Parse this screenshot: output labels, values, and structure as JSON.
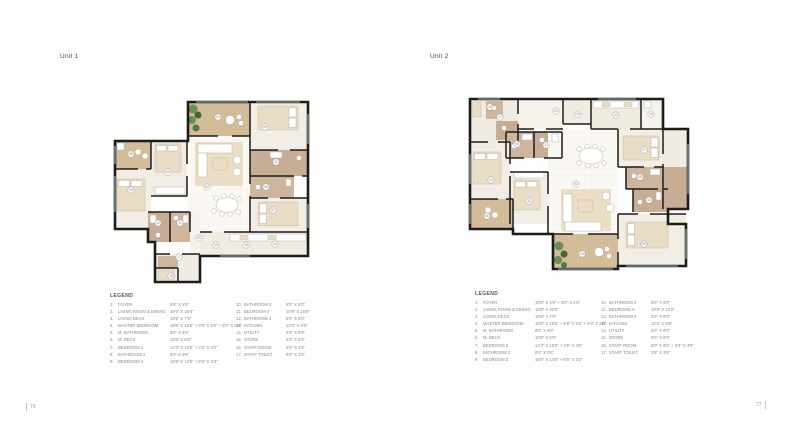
{
  "page": {
    "left_page_number": "76",
    "right_page_number": "77"
  },
  "palette": {
    "wall": "#1c1c1c",
    "deck_wood": "#d6bf9c",
    "room_floor": "#f3eee5",
    "bathroom": "#c7ad94",
    "bathroom_light": "#cdb59e",
    "plant_green": "#6a8e55",
    "rug": "#e7d9bc",
    "window": "#9fb9b5"
  },
  "units": [
    {
      "title": "Unit 1",
      "legend_title": "LEGEND",
      "legend": [
        {
          "num": "1.",
          "label": "FOYER",
          "dim": "5'6\" X 8'9\""
        },
        {
          "num": "2.",
          "label": "LIVING ROOM & DINING",
          "dim": "18'6\" X 28'6\""
        },
        {
          "num": "3.",
          "label": "LIVING DECK",
          "dim": "18'6\" X 7'9\""
        },
        {
          "num": "4.",
          "label": "MASTER BEDROOM",
          "dim": "18'6\" X 16'6\" + 8'9\" X 5'6\" + 6'0\" X 2'0\""
        },
        {
          "num": "5.",
          "label": "M. BATHROOM",
          "dim": "8'0\" X 8'6\""
        },
        {
          "num": "6.",
          "label": "M. DECK",
          "dim": "18'6\" X 5'9\""
        },
        {
          "num": "7.",
          "label": "BEDROOM 2",
          "dim": "12'3\" X 10'9\" + 3'6\" X 4'0\""
        },
        {
          "num": "8.",
          "label": "BATHROOM 2",
          "dim": "8'0\" X 5'6\""
        },
        {
          "num": "9.",
          "label": "BEDROOM 3",
          "dim": "15'6\" X 12'6\" + 8'6\" X 3'3\""
        },
        {
          "num": "10.",
          "label": "BATHROOM 3",
          "dim": "9'0\" X 6'0\""
        },
        {
          "num": "11.",
          "label": "BEDROOM 4",
          "dim": "10'9\" X 15'9\""
        },
        {
          "num": "12.",
          "label": "BATHROOM 4",
          "dim": "5'0\" X 8'0\""
        },
        {
          "num": "13.",
          "label": "KITCHEN",
          "dim": "12'9\" X 8'9\""
        },
        {
          "num": "14.",
          "label": "UTILITY",
          "dim": "5'0\" X 8'0\""
        },
        {
          "num": "15.",
          "label": "STORE",
          "dim": "5'0\" X 6'0\""
        },
        {
          "num": "16.",
          "label": "STAFF ROOM",
          "dim": "9'0\" X 4'9\""
        },
        {
          "num": "17.",
          "label": "STAFF TOILET",
          "dim": "5'0\" X 4'6\""
        }
      ],
      "plan_markers": [
        {
          "n": "06",
          "x": 31,
          "y": 70
        },
        {
          "n": "03",
          "x": 118,
          "y": 33
        },
        {
          "n": "09",
          "x": 165,
          "y": 43
        },
        {
          "n": "05",
          "x": 68,
          "y": 88
        },
        {
          "n": "04",
          "x": 31,
          "y": 106
        },
        {
          "n": "02",
          "x": 107,
          "y": 103
        },
        {
          "n": "10",
          "x": 176,
          "y": 78
        },
        {
          "n": "08",
          "x": 166,
          "y": 103
        },
        {
          "n": "07",
          "x": 173,
          "y": 126
        },
        {
          "n": "12",
          "x": 58,
          "y": 139
        },
        {
          "n": "11",
          "x": 80,
          "y": 139
        },
        {
          "n": "01",
          "x": 99,
          "y": 154
        },
        {
          "n": "15",
          "x": 116,
          "y": 161
        },
        {
          "n": "13",
          "x": 146,
          "y": 161
        },
        {
          "n": "14",
          "x": 175,
          "y": 160
        },
        {
          "n": "17",
          "x": 79,
          "y": 173
        },
        {
          "n": "16",
          "x": 71,
          "y": 192
        }
      ]
    },
    {
      "title": "Unit 2",
      "legend_title": "LEGEND",
      "legend": [
        {
          "num": "1.",
          "label": "FOYER",
          "dim": "10'6\" X 4'6\" + 5'0\" X 4'9\""
        },
        {
          "num": "2.",
          "label": "LIVING ROOM & DINING",
          "dim": "18'6\" X 30'0\""
        },
        {
          "num": "3.",
          "label": "LIVING DECK",
          "dim": "18'6\" X 7'9\""
        },
        {
          "num": "4.",
          "label": "MASTER BEDROOM",
          "dim": "18'6\" X 16'6\" + 8'9\" X 5'6\" + 6'0\" X 2'0\""
        },
        {
          "num": "5.",
          "label": "M. BATHROOM",
          "dim": "8'0\" X 8'6\""
        },
        {
          "num": "6.",
          "label": "M. DECK",
          "dim": "18'6\" X 5'9\""
        },
        {
          "num": "7.",
          "label": "BEDROOM 2",
          "dim": "12'3\" X 10'9\" + 3'6\" X 4'0\""
        },
        {
          "num": "8.",
          "label": "BATHROOM 2",
          "dim": "8'0\" X 5'6\""
        },
        {
          "num": "9.",
          "label": "BEDROOM 3",
          "dim": "15'6\" X 14'6\" + 6'9\" X 3'3\""
        },
        {
          "num": "10.",
          "label": "BATHROOM 3",
          "dim": "9'0\" X 6'0\""
        },
        {
          "num": "11.",
          "label": "BEDROOM 4",
          "dim": "10'9\" X 15'9\""
        },
        {
          "num": "12.",
          "label": "BATHROOM 4",
          "dim": "5'0\" X 8'0\""
        },
        {
          "num": "13.",
          "label": "KITCHEN",
          "dim": "12'9\" X 8'9\""
        },
        {
          "num": "14.",
          "label": "UTILITY",
          "dim": "5'0\" X 8'0\""
        },
        {
          "num": "15.",
          "label": "STORE",
          "dim": "5'0\" X 6'0\""
        },
        {
          "num": "16.",
          "label": "STAFF ROOM",
          "dim": "6'0\" X 6'6\" + 3'3\" X 3'9\""
        },
        {
          "num": "17.",
          "label": "STAFF TOILET",
          "dim": "3'9\" X 3'9\""
        }
      ],
      "plan_markers": [
        {
          "n": "16",
          "x": 32,
          "y": 23
        },
        {
          "n": "17",
          "x": 42,
          "y": 33
        },
        {
          "n": "05",
          "x": 59,
          "y": 60
        },
        {
          "n": "12",
          "x": 88,
          "y": 61
        },
        {
          "n": "01",
          "x": 98,
          "y": 27
        },
        {
          "n": "15",
          "x": 120,
          "y": 30
        },
        {
          "n": "13",
          "x": 158,
          "y": 31
        },
        {
          "n": "14",
          "x": 193,
          "y": 30
        },
        {
          "n": "07",
          "x": 186,
          "y": 66
        },
        {
          "n": "04",
          "x": 33,
          "y": 96
        },
        {
          "n": "11",
          "x": 71,
          "y": 117
        },
        {
          "n": "02",
          "x": 118,
          "y": 100
        },
        {
          "n": "08",
          "x": 182,
          "y": 93
        },
        {
          "n": "10",
          "x": 191,
          "y": 116
        },
        {
          "n": "06",
          "x": 29,
          "y": 132
        },
        {
          "n": "03",
          "x": 124,
          "y": 170
        },
        {
          "n": "09",
          "x": 186,
          "y": 160
        }
      ]
    }
  ]
}
